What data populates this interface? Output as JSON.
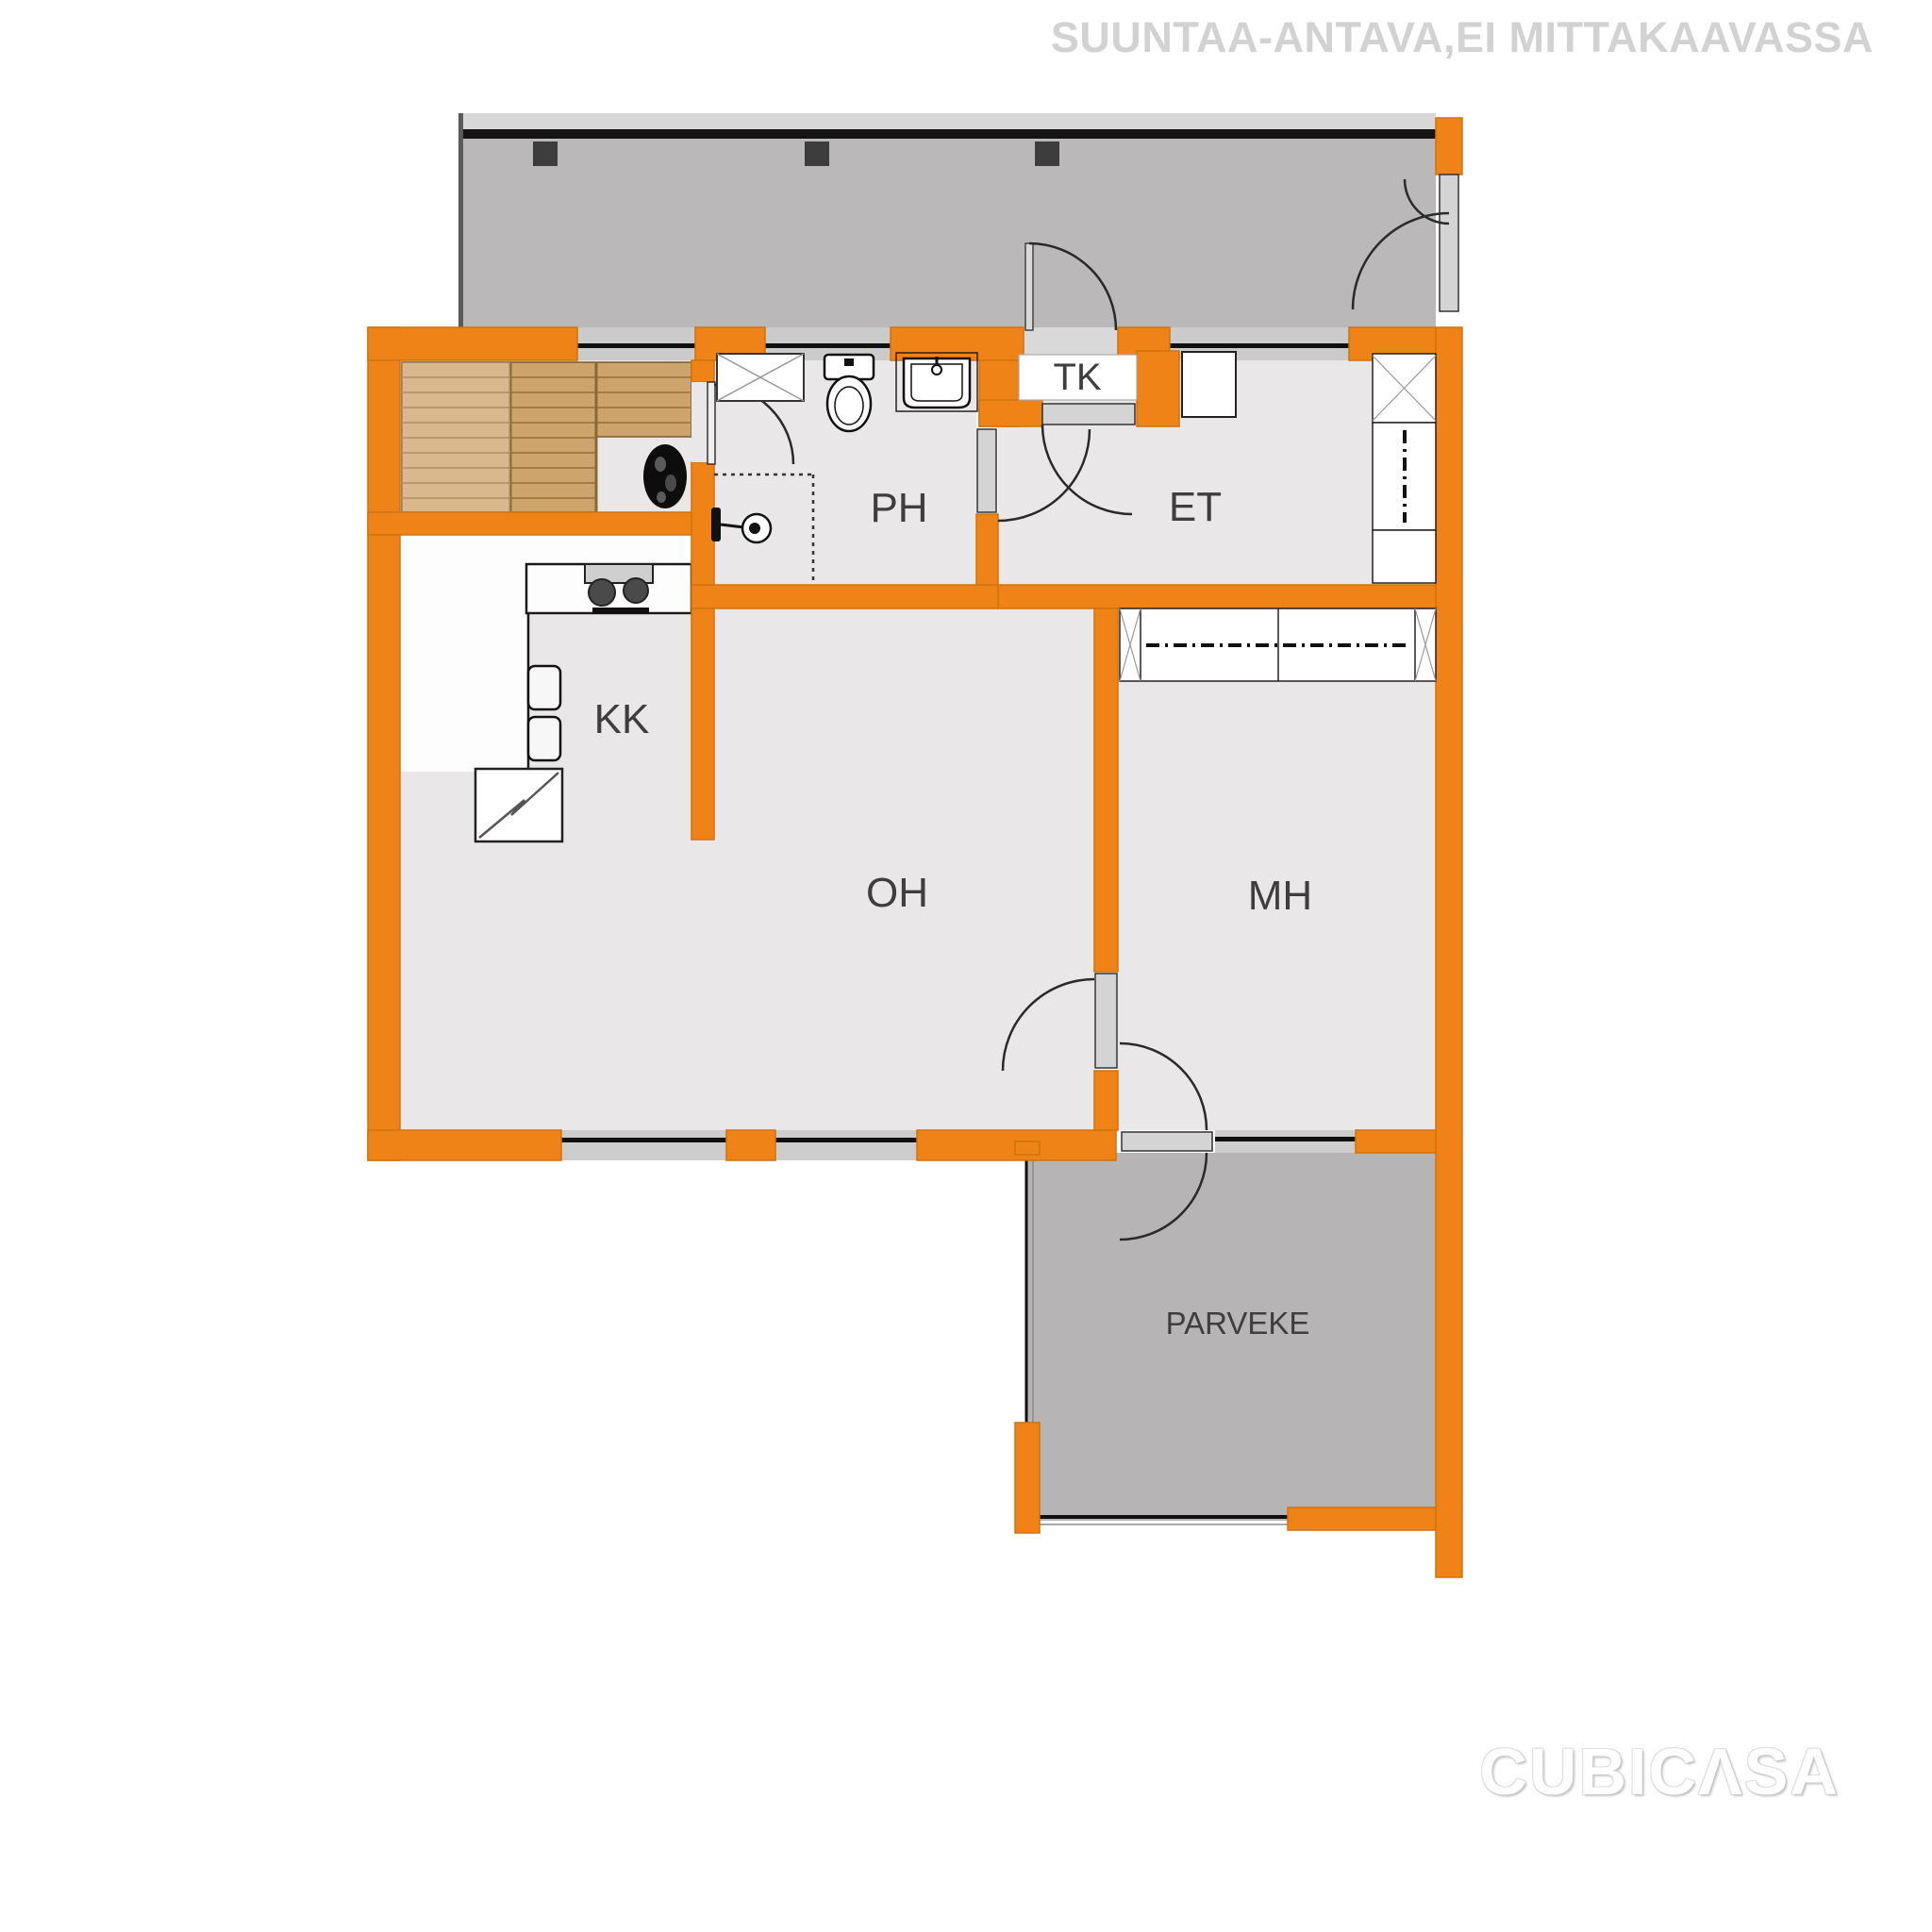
{
  "header": {
    "disclaimer": "SUUNTAA-ANTAVA,EI MITTAKAAVASSA"
  },
  "branding": {
    "logo_text": "CUBICΛSA"
  },
  "rooms": [
    {
      "label": "TK"
    },
    {
      "label": "PH"
    },
    {
      "label": "ET"
    },
    {
      "label": "KK"
    },
    {
      "label": "OH"
    },
    {
      "label": "MH"
    },
    {
      "label": "PARVEKE"
    }
  ],
  "colors": {
    "wall_accent": "#ef8318",
    "room_floor": "#e9e7e7",
    "corridor_floor": "#bab8b8",
    "balcony_floor": "#b6b4b4",
    "sauna_bench_wood": "#cda56c",
    "label_text": "#3e3e3e",
    "disclaimer_text": "#d2d2d2"
  },
  "icons": [
    "toilet-icon",
    "sink-icon",
    "shower-icon",
    "sauna-stove-icon",
    "sauna-bench-icon",
    "cooktop-icon",
    "refrigerator-icon",
    "basin-icon",
    "reservation-x-box-icon",
    "wardrobe-icon",
    "door-swing-icon",
    "window-icon",
    "pillar-icon"
  ]
}
